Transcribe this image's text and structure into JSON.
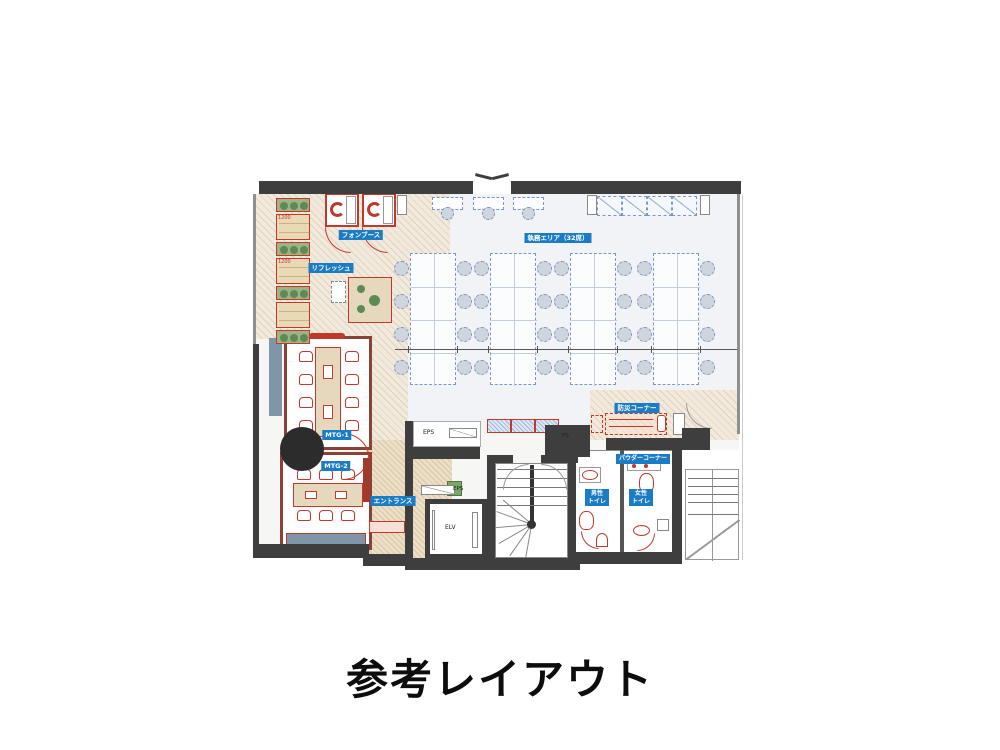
{
  "title": "参考レイアウト",
  "plan": {
    "labels": {
      "work_area": "執務エリア（32席）",
      "phone_booth": "フォンブース",
      "refresh": "リフレッシュ",
      "mtg1": "MTG-1",
      "mtg2": "MTG-2",
      "entrance": "エントランス",
      "disaster_corner": "防災コーナー",
      "powder_corner": "パウダーコーナー",
      "mens_toilet": "男性\nトイレ",
      "womens_toilet": "女性\nトイレ",
      "eps_main": "EPS",
      "eps_small": "EPS",
      "ps": "PS",
      "elevator": "ELV"
    },
    "dimensions": {
      "bench_width": "1200"
    },
    "desk_grid": {
      "columns": 4,
      "rows": 4,
      "seats_per_row": 2,
      "total_seats": 32
    },
    "wall_desks": 3,
    "lockers": 4,
    "left_strip": {
      "planters": 4,
      "benches": 3
    },
    "mtg_rooms": {
      "mtg1_seats": 8,
      "mtg2_seats": 6
    },
    "stairs": {
      "steps": 5,
      "fan_lines": 6
    },
    "colors": {
      "wall": "#3e3e3e",
      "accent_red": "#c0392b",
      "room_wall": "#8c4136",
      "label_blue": "#1a7cc4",
      "furniture_blue": "#7b97c8",
      "planter_green": "#9cb386",
      "wood": "#e6d8bd",
      "cabinet_blue_gray": "#7e96a8"
    }
  }
}
